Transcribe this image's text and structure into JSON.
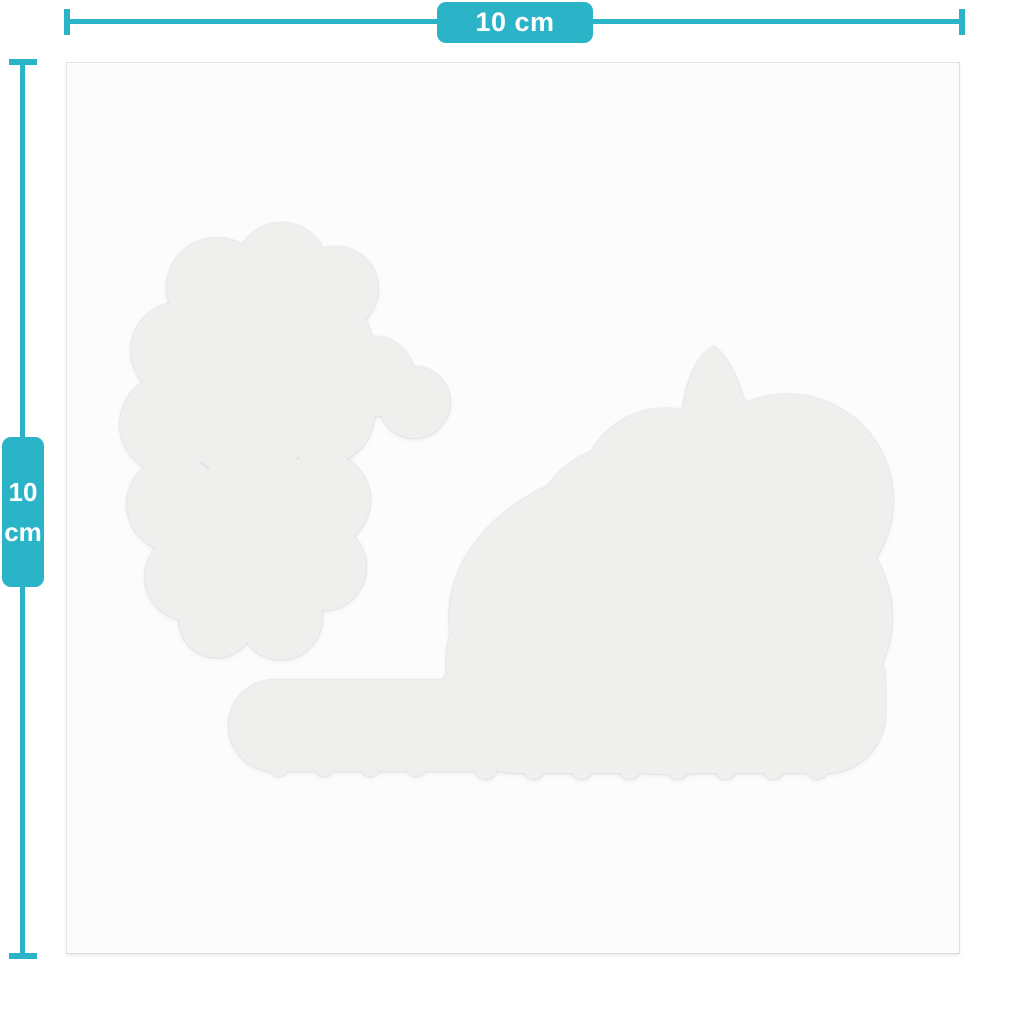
{
  "measurements": {
    "width_label": "10 cm",
    "height_value": "10",
    "height_unit": "cm"
  },
  "colors": {
    "accent_teal": "#2bb4c8",
    "label_text": "#ffffff",
    "page_background": "#ffffff",
    "card_background": "#fcfcfc",
    "card_border": "#e3e3e3",
    "silhouette_fill": "#efefed"
  },
  "icons": {
    "silhouette": "lying-cat-sticker-silhouette"
  }
}
